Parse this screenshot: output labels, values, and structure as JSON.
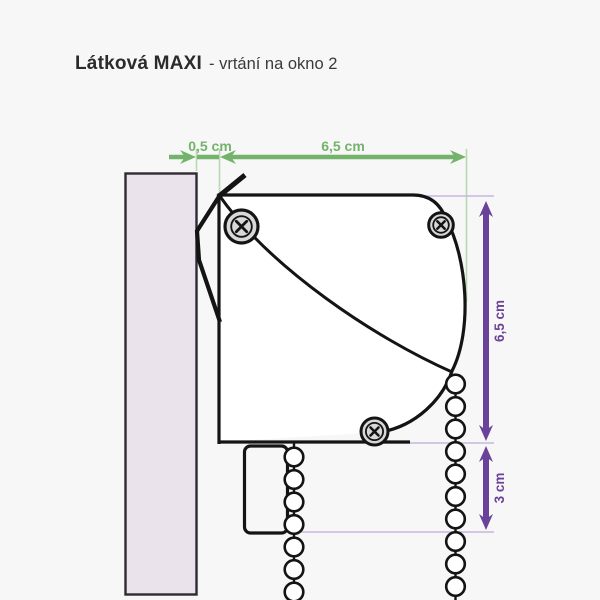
{
  "title": {
    "product": "Látková MAXI",
    "subtitle": "- vrtání na okno 2"
  },
  "dimensions": {
    "offset_top": "0,5 cm",
    "width_top": "6,5 cm",
    "height_right": "6,5 cm",
    "chain_drop": "3 cm"
  },
  "colors": {
    "bg": "#f7f7f7",
    "title_ink": "#2b2b2b",
    "ink": "#141414",
    "green": "#74b36b",
    "green_light": "#b7d9b0",
    "purple": "#6a4299",
    "purple_light": "#c8b7e0",
    "wall_fill": "#eae3ec",
    "screw_fill": "#d8d8d8"
  }
}
